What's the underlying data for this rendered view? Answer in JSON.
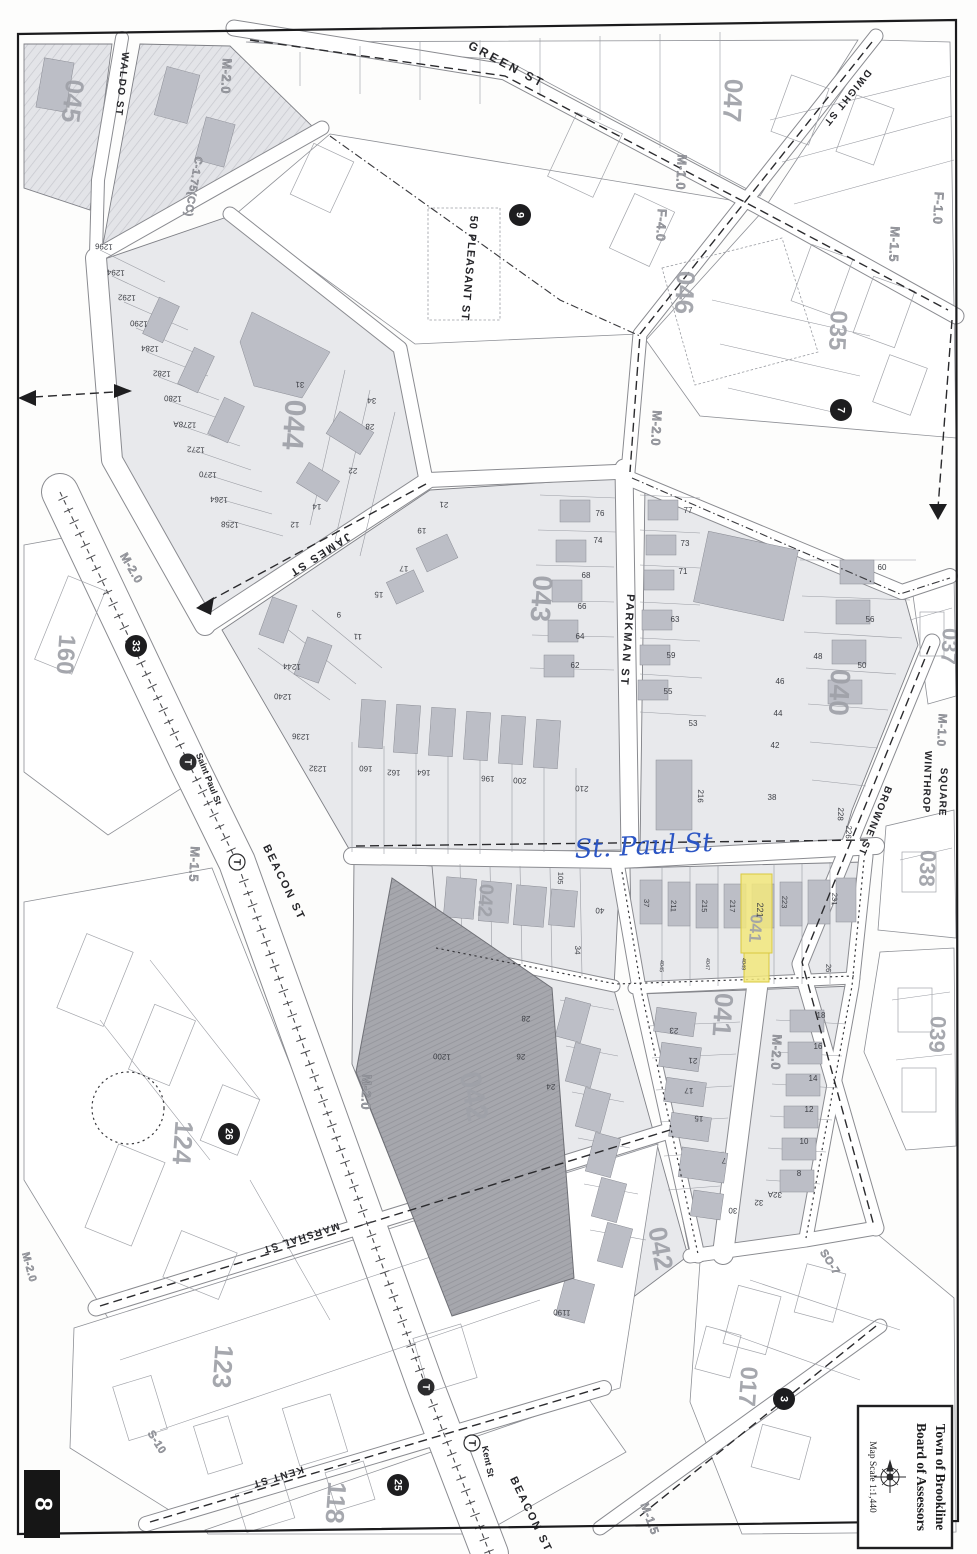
{
  "page": {
    "number": "8"
  },
  "title_block": {
    "line1": "Town of Brookline",
    "line2": "Board of Assessors",
    "scale": "Map Scale 1:1,440",
    "compass_icon": "compass-rose-icon"
  },
  "annotation": {
    "handwritten": "St. Paul St",
    "ink": "#2b55c4"
  },
  "highlight": {
    "parcel": "221",
    "color": "#f2e87c"
  },
  "colors": {
    "paper": "#fdfdfc",
    "block_fill": "#e8e9ec",
    "building_fill": "#bcbec6",
    "dark_building": "#a4a5ab",
    "highlight": "#f2e87c",
    "annotation_ink": "#2b55c4"
  },
  "map": {
    "block_labels": [
      {
        "t": "045",
        "x": 64,
        "y": 100,
        "r": 97,
        "s": 26
      },
      {
        "t": "044",
        "x": 284,
        "y": 424,
        "r": 94,
        "s": 30
      },
      {
        "t": "047",
        "x": 724,
        "y": 100,
        "r": 93,
        "s": 26
      },
      {
        "t": "046",
        "x": 676,
        "y": 292,
        "r": 93,
        "s": 26
      },
      {
        "t": "035",
        "x": 830,
        "y": 330,
        "r": 93,
        "s": 24
      },
      {
        "t": "043",
        "x": 532,
        "y": 598,
        "r": 94,
        "s": 28
      },
      {
        "t": "040",
        "x": 830,
        "y": 692,
        "r": 93,
        "s": 28
      },
      {
        "t": "037",
        "x": 942,
        "y": 646,
        "r": 93,
        "s": 22
      },
      {
        "t": "038",
        "x": 920,
        "y": 868,
        "r": 93,
        "s": 22
      },
      {
        "t": "039",
        "x": 930,
        "y": 1034,
        "r": 93,
        "s": 22
      },
      {
        "t": "160",
        "x": 58,
        "y": 654,
        "r": 94,
        "s": 24
      },
      {
        "t": "042",
        "x": 479,
        "y": 900,
        "r": 94,
        "s": 20
      },
      {
        "t": "042",
        "x": 464,
        "y": 1098,
        "r": 80,
        "s": 30
      },
      {
        "t": "042",
        "x": 652,
        "y": 1250,
        "r": 80,
        "s": 26
      },
      {
        "t": "041",
        "x": 714,
        "y": 1014,
        "r": 94,
        "s": 26
      },
      {
        "t": "041",
        "x": 750,
        "y": 928,
        "r": 94,
        "s": 17
      },
      {
        "t": "124",
        "x": 174,
        "y": 1142,
        "r": 94,
        "s": 26
      },
      {
        "t": "123",
        "x": 214,
        "y": 1366,
        "r": 94,
        "s": 26
      },
      {
        "t": "118",
        "x": 327,
        "y": 1502,
        "r": 94,
        "s": 26
      },
      {
        "t": "017",
        "x": 740,
        "y": 1386,
        "r": 94,
        "s": 24
      }
    ],
    "street_labels": [
      {
        "t": "GREEN ST",
        "x": 505,
        "y": 68,
        "r": 28,
        "s": 12,
        "sp": 3
      },
      {
        "t": "WALDO ST",
        "x": 119,
        "y": 84,
        "r": 96,
        "s": 10,
        "sp": 1.5
      },
      {
        "t": "DWIGHT ST",
        "x": 845,
        "y": 96,
        "r": 129,
        "s": 10,
        "sp": 1.5
      },
      {
        "t": "50 PLEASANT ST",
        "x": 466,
        "y": 268,
        "r": 95,
        "s": 11,
        "sp": 1
      },
      {
        "t": "JAMES ST",
        "x": 318,
        "y": 552,
        "r": 147,
        "s": 11,
        "sp": 2
      },
      {
        "t": "PARKMAN ST",
        "x": 624,
        "y": 640,
        "r": 94,
        "s": 11,
        "sp": 2
      },
      {
        "t": "BROWNE ST",
        "x": 872,
        "y": 820,
        "r": 112,
        "s": 10,
        "sp": 1.5
      },
      {
        "t": "WINTHROP",
        "x": 924,
        "y": 782,
        "r": 92,
        "s": 10,
        "sp": 1
      },
      {
        "t": "SQUARE",
        "x": 940,
        "y": 792,
        "r": 92,
        "s": 10,
        "sp": 1
      },
      {
        "t": "BEACON ST",
        "x": 281,
        "y": 884,
        "r": 64,
        "s": 11,
        "sp": 2
      },
      {
        "t": "BEACON ST",
        "x": 528,
        "y": 1516,
        "r": 64,
        "s": 11,
        "sp": 2
      },
      {
        "t": "MARSHAL ST",
        "x": 300,
        "y": 1235,
        "r": 162,
        "s": 10,
        "sp": 1.5
      },
      {
        "t": "KENT ST",
        "x": 277,
        "y": 1474,
        "r": 163,
        "s": 10,
        "sp": 1.5
      },
      {
        "t": "Saint Paul St",
        "x": 206,
        "y": 780,
        "r": 68,
        "s": 9,
        "sp": 0
      },
      {
        "t": "Kent St",
        "x": 485,
        "y": 1462,
        "r": 78,
        "s": 9,
        "sp": 0
      }
    ],
    "zoning_labels": [
      {
        "t": "M-2.0",
        "x": 222,
        "y": 76,
        "r": 93,
        "s": 13
      },
      {
        "t": "C-1.75(CC)",
        "x": 190,
        "y": 186,
        "r": 100,
        "s": 11
      },
      {
        "t": "M-1.0",
        "x": 677,
        "y": 172,
        "r": 93,
        "s": 13
      },
      {
        "t": "F-4.0",
        "x": 657,
        "y": 225,
        "r": 93,
        "s": 13
      },
      {
        "t": "F-1.0",
        "x": 934,
        "y": 208,
        "r": 93,
        "s": 13
      },
      {
        "t": "M-1.5",
        "x": 890,
        "y": 244,
        "r": 93,
        "s": 13
      },
      {
        "t": "M-1.0",
        "x": 938,
        "y": 730,
        "r": 93,
        "s": 12
      },
      {
        "t": "M-2.0",
        "x": 652,
        "y": 428,
        "r": 93,
        "s": 13
      },
      {
        "t": "M-2.0",
        "x": 128,
        "y": 570,
        "r": 60,
        "s": 12
      },
      {
        "t": "M-1.5",
        "x": 190,
        "y": 864,
        "r": 93,
        "s": 13
      },
      {
        "t": "M-2.0",
        "x": 362,
        "y": 1092,
        "r": 93,
        "s": 13
      },
      {
        "t": "M-2.0",
        "x": 772,
        "y": 1052,
        "r": 93,
        "s": 13
      },
      {
        "t": "M-2.0",
        "x": 26,
        "y": 1268,
        "r": 75,
        "s": 11
      },
      {
        "t": "S-10",
        "x": 154,
        "y": 1444,
        "r": 58,
        "s": 11
      },
      {
        "t": "SO-7",
        "x": 827,
        "y": 1264,
        "r": 58,
        "s": 11
      },
      {
        "t": "M-1.5",
        "x": 646,
        "y": 1520,
        "r": 70,
        "s": 12
      }
    ],
    "parcel_labels": [
      {
        "t": "1296",
        "x": 104,
        "y": 244,
        "r": 183
      },
      {
        "t": "1294",
        "x": 116,
        "y": 270,
        "r": 183
      },
      {
        "t": "1292",
        "x": 127,
        "y": 295,
        "r": 183
      },
      {
        "t": "1290",
        "x": 139,
        "y": 321,
        "r": 183
      },
      {
        "t": "1284",
        "x": 150,
        "y": 346,
        "r": 183
      },
      {
        "t": "1282",
        "x": 162,
        "y": 371,
        "r": 183
      },
      {
        "t": "1280",
        "x": 173,
        "y": 396,
        "r": 183
      },
      {
        "t": "1278A",
        "x": 185,
        "y": 422,
        "r": 183
      },
      {
        "t": "1272",
        "x": 196,
        "y": 447,
        "r": 183
      },
      {
        "t": "1270",
        "x": 208,
        "y": 472,
        "r": 183
      },
      {
        "t": "1264",
        "x": 219,
        "y": 497,
        "r": 183
      },
      {
        "t": "1258",
        "x": 230,
        "y": 522,
        "r": 183
      },
      {
        "t": "34",
        "x": 372,
        "y": 398,
        "r": 183
      },
      {
        "t": "28",
        "x": 370,
        "y": 424,
        "r": 183
      },
      {
        "t": "22",
        "x": 353,
        "y": 468,
        "r": 183
      },
      {
        "t": "14",
        "x": 317,
        "y": 504,
        "r": 183
      },
      {
        "t": "12",
        "x": 295,
        "y": 522,
        "r": 183
      },
      {
        "t": "31",
        "x": 300,
        "y": 382,
        "r": 183
      },
      {
        "t": "1244",
        "x": 292,
        "y": 664,
        "r": 183
      },
      {
        "t": "1240",
        "x": 283,
        "y": 694,
        "r": 183
      },
      {
        "t": "1236",
        "x": 301,
        "y": 734,
        "r": 183
      },
      {
        "t": "1232",
        "x": 318,
        "y": 766,
        "r": 183
      },
      {
        "t": "160",
        "x": 366,
        "y": 766,
        "r": 183
      },
      {
        "t": "162",
        "x": 394,
        "y": 770,
        "r": 183
      },
      {
        "t": "164",
        "x": 424,
        "y": 770,
        "r": 183
      },
      {
        "t": "196",
        "x": 488,
        "y": 776,
        "r": 183
      },
      {
        "t": "200",
        "x": 520,
        "y": 778,
        "r": 183
      },
      {
        "t": "210",
        "x": 582,
        "y": 786,
        "r": 183
      },
      {
        "t": "21",
        "x": 444,
        "y": 502,
        "r": 183
      },
      {
        "t": "19",
        "x": 422,
        "y": 528,
        "r": 183
      },
      {
        "t": "17",
        "x": 404,
        "y": 566,
        "r": 183
      },
      {
        "t": "15",
        "x": 379,
        "y": 592,
        "r": 183
      },
      {
        "t": "11",
        "x": 358,
        "y": 634,
        "r": 183
      },
      {
        "t": "9",
        "x": 339,
        "y": 612,
        "r": 183
      },
      {
        "t": "76",
        "x": 600,
        "y": 516,
        "r": 0
      },
      {
        "t": "74",
        "x": 598,
        "y": 543,
        "r": 0
      },
      {
        "t": "68",
        "x": 586,
        "y": 578,
        "r": 0
      },
      {
        "t": "66",
        "x": 582,
        "y": 609,
        "r": 0
      },
      {
        "t": "64",
        "x": 580,
        "y": 639,
        "r": 0
      },
      {
        "t": "62",
        "x": 575,
        "y": 668,
        "r": 0
      },
      {
        "t": "77",
        "x": 688,
        "y": 513,
        "r": 0
      },
      {
        "t": "73",
        "x": 685,
        "y": 546,
        "r": 0
      },
      {
        "t": "71",
        "x": 683,
        "y": 574,
        "r": 0
      },
      {
        "t": "63",
        "x": 675,
        "y": 622,
        "r": 0
      },
      {
        "t": "59",
        "x": 671,
        "y": 658,
        "r": 0
      },
      {
        "t": "55",
        "x": 668,
        "y": 694,
        "r": 0
      },
      {
        "t": "53",
        "x": 693,
        "y": 726,
        "r": 0
      },
      {
        "t": "60",
        "x": 882,
        "y": 570,
        "r": 0
      },
      {
        "t": "56",
        "x": 870,
        "y": 622,
        "r": 0
      },
      {
        "t": "50",
        "x": 862,
        "y": 668,
        "r": 0
      },
      {
        "t": "48",
        "x": 818,
        "y": 659,
        "r": 0
      },
      {
        "t": "46",
        "x": 780,
        "y": 684,
        "r": 0
      },
      {
        "t": "44",
        "x": 778,
        "y": 716,
        "r": 0
      },
      {
        "t": "42",
        "x": 775,
        "y": 748,
        "r": 0
      },
      {
        "t": "38",
        "x": 772,
        "y": 800,
        "r": 0
      },
      {
        "t": "216",
        "x": 698,
        "y": 796,
        "r": 92
      },
      {
        "t": "228",
        "x": 838,
        "y": 814,
        "r": 92
      },
      {
        "t": "226",
        "x": 846,
        "y": 832,
        "r": 92
      },
      {
        "t": "37",
        "x": 644,
        "y": 903,
        "r": 92,
        "s": 7.5
      },
      {
        "t": "211",
        "x": 671,
        "y": 906,
        "r": 92,
        "s": 7.5
      },
      {
        "t": "215",
        "x": 702,
        "y": 906,
        "r": 92,
        "s": 7.5
      },
      {
        "t": "217",
        "x": 730,
        "y": 906,
        "r": 92,
        "s": 7.5
      },
      {
        "t": "223",
        "x": 782,
        "y": 902,
        "r": 92,
        "s": 7.5
      },
      {
        "t": "231",
        "x": 832,
        "y": 899,
        "r": 92,
        "s": 7.5
      },
      {
        "t": "26",
        "x": 826,
        "y": 968,
        "r": 92,
        "s": 7.5
      },
      {
        "t": "4045",
        "x": 660,
        "y": 966,
        "r": 92,
        "s": 5.5
      },
      {
        "t": "4047",
        "x": 706,
        "y": 964,
        "r": 92,
        "s": 5.5
      },
      {
        "t": "4049",
        "x": 742,
        "y": 964,
        "r": 92,
        "s": 5.5
      },
      {
        "t": "105",
        "x": 558,
        "y": 878,
        "r": 92,
        "s": 7.5
      },
      {
        "t": "40",
        "x": 600,
        "y": 908,
        "r": 183
      },
      {
        "t": "34",
        "x": 575,
        "y": 950,
        "r": 92
      },
      {
        "t": "1200",
        "x": 442,
        "y": 1054,
        "r": 183
      },
      {
        "t": "28",
        "x": 526,
        "y": 1016,
        "r": 183
      },
      {
        "t": "26",
        "x": 521,
        "y": 1054,
        "r": 183
      },
      {
        "t": "24",
        "x": 551,
        "y": 1084,
        "r": 183
      },
      {
        "t": "1190",
        "x": 562,
        "y": 1310,
        "r": 183
      },
      {
        "t": "23",
        "x": 674,
        "y": 1028,
        "r": 183
      },
      {
        "t": "21",
        "x": 693,
        "y": 1058,
        "r": 183
      },
      {
        "t": "17",
        "x": 689,
        "y": 1088,
        "r": 183
      },
      {
        "t": "15",
        "x": 699,
        "y": 1116,
        "r": 183
      },
      {
        "t": "7",
        "x": 724,
        "y": 1158,
        "r": 183
      },
      {
        "t": "30",
        "x": 733,
        "y": 1208,
        "r": 183
      },
      {
        "t": "32",
        "x": 759,
        "y": 1200,
        "r": 183
      },
      {
        "t": "32A",
        "x": 775,
        "y": 1192,
        "r": 183
      },
      {
        "t": "18",
        "x": 821,
        "y": 1018,
        "r": 0
      },
      {
        "t": "16",
        "x": 818,
        "y": 1049,
        "r": 0
      },
      {
        "t": "14",
        "x": 813,
        "y": 1081,
        "r": 0
      },
      {
        "t": "12",
        "x": 809,
        "y": 1112,
        "r": 0
      },
      {
        "t": "10",
        "x": 804,
        "y": 1144,
        "r": 0
      },
      {
        "t": "8",
        "x": 799,
        "y": 1176,
        "r": 0
      }
    ],
    "badges": [
      {
        "t": "9",
        "x": 520,
        "y": 215
      },
      {
        "t": "7",
        "x": 841,
        "y": 410
      },
      {
        "t": "33",
        "x": 136,
        "y": 646
      },
      {
        "t": "26",
        "x": 229,
        "y": 1134
      },
      {
        "t": "25",
        "x": 398,
        "y": 1485
      },
      {
        "t": "3",
        "x": 784,
        "y": 1399
      }
    ],
    "stations": [
      {
        "x": 188,
        "y": 762,
        "filled": true
      },
      {
        "x": 237,
        "y": 862,
        "filled": false
      },
      {
        "x": 426,
        "y": 1387,
        "filled": true
      },
      {
        "x": 472,
        "y": 1443,
        "filled": false
      }
    ],
    "highlight_parcel_label": {
      "t": "221",
      "x": 757,
      "y": 910,
      "r": 92,
      "s": 9
    }
  }
}
